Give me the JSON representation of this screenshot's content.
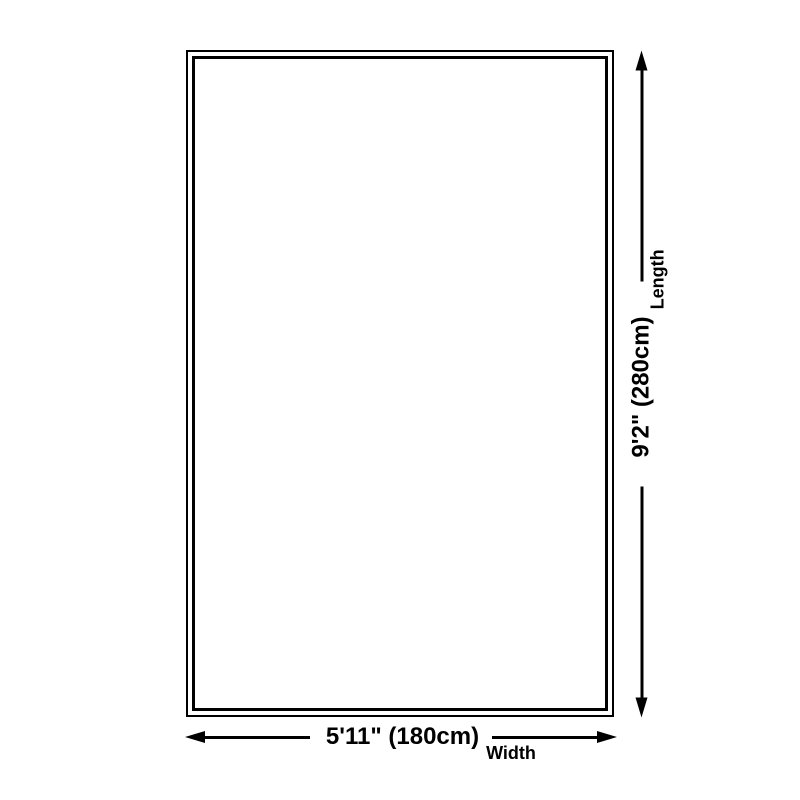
{
  "diagram": {
    "background_color": "#ffffff",
    "line_color": "#000000",
    "length": {
      "value": "9'2\" (280cm)",
      "label": "Length"
    },
    "width": {
      "value": "5'11\" (180cm)",
      "label": "Width"
    }
  }
}
